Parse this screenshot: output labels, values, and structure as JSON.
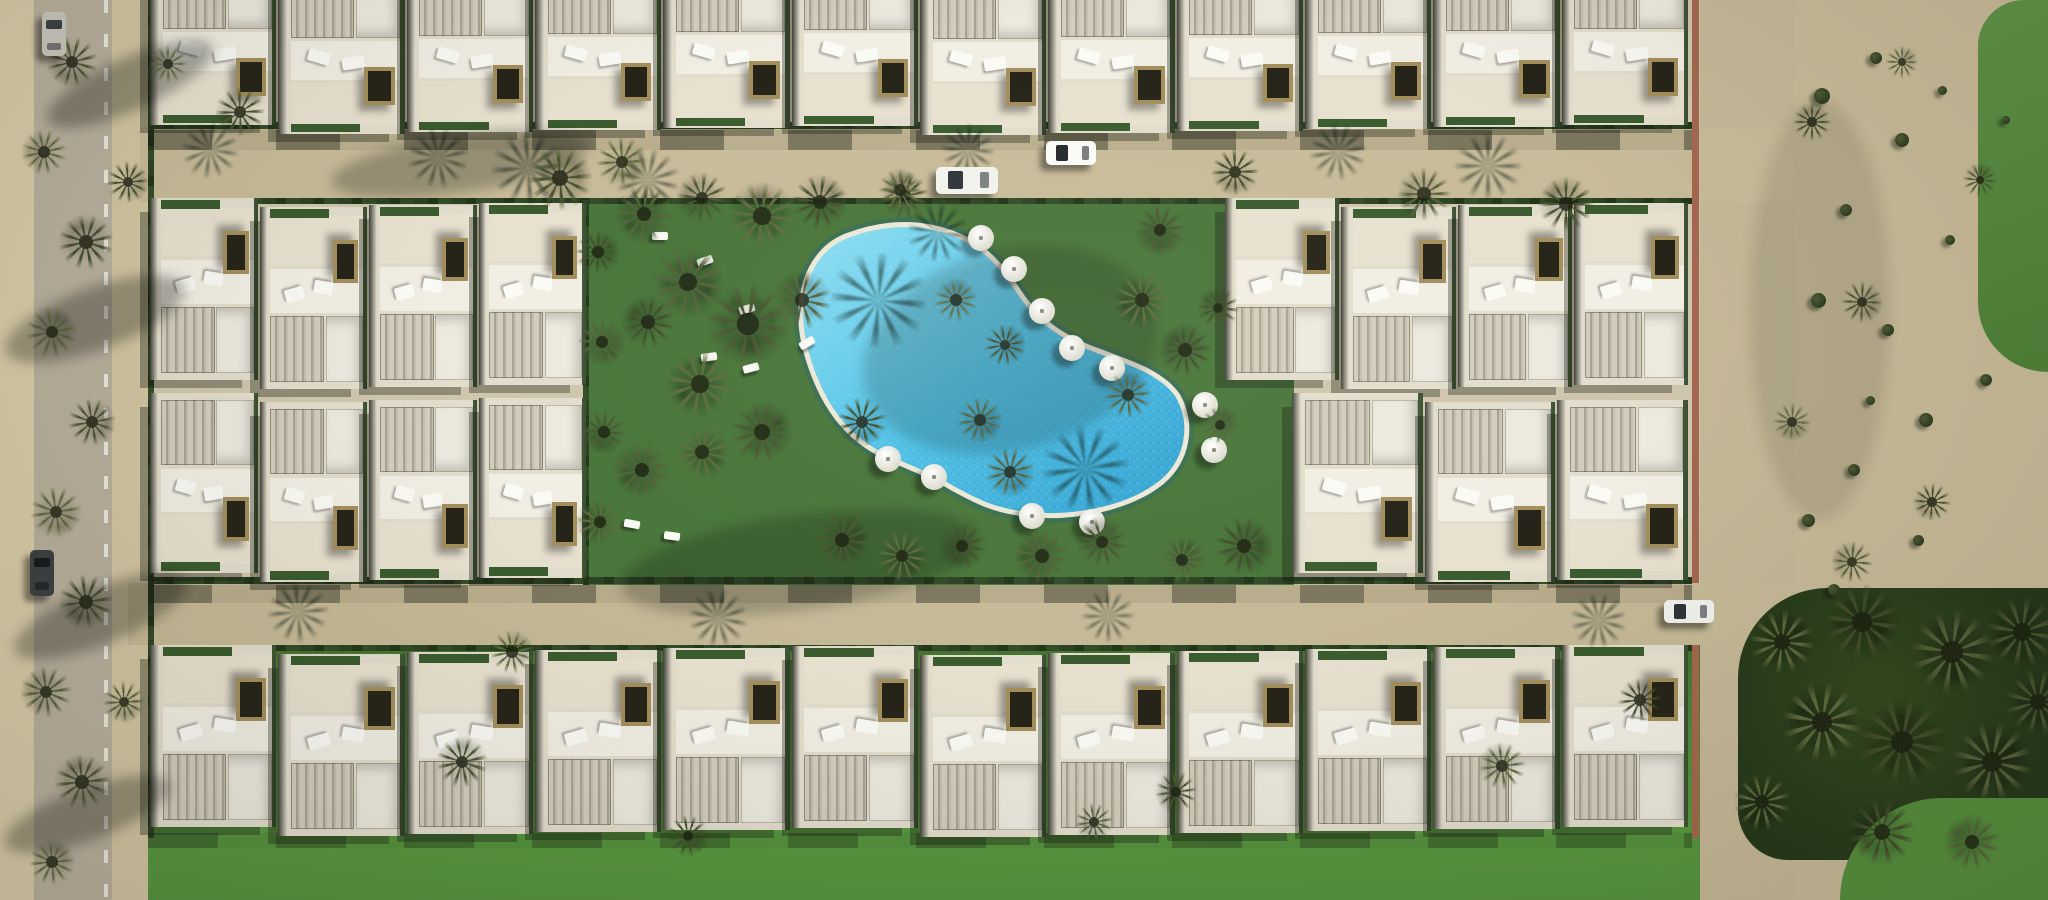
{
  "scene": {
    "width": 2048,
    "height": 900,
    "background": "#c9bc9a",
    "subject": "aerial-3d-render-villa-resort-with-kidney-pool"
  },
  "palette": {
    "road_sand": "#c8bb99",
    "street_grey": "#b9af9d",
    "dune_sand": "#c7ba98",
    "garden_green": "#49763a",
    "lawn_green": "#4f8739",
    "pool_water": "#4cc0e6",
    "villa_white": "#e2ddcd",
    "hedge_green": "#2c4323",
    "wall_terracotta": "#a4674f"
  },
  "regions": [
    {
      "name": "left-sidewalk",
      "x": 0,
      "y": 0,
      "w": 34,
      "h": 900,
      "bg": "#d8cba8",
      "cls": "tex-dune"
    },
    {
      "name": "left-street",
      "x": 34,
      "y": 0,
      "w": 78,
      "h": 900,
      "bg": "#b9af9d",
      "cls": "tex-road"
    },
    {
      "name": "left-street-dash-line",
      "x": 104,
      "y": 0,
      "w": 4,
      "h": 900,
      "bg": "repeating-linear-gradient(180deg, rgba(250,250,243,0.75) 0px 13px, rgba(250,250,243,0) 13px 34px)"
    },
    {
      "name": "left-shoulder",
      "x": 112,
      "y": 0,
      "w": 36,
      "h": 900,
      "bg": "#d2c5a2",
      "cls": "tex-dune"
    },
    {
      "name": "development-ground",
      "x": 148,
      "y": 0,
      "w": 1554,
      "h": 900,
      "bg": "#cfc6ad"
    },
    {
      "name": "right-dune",
      "x": 1795,
      "y": 0,
      "w": 253,
      "h": 900,
      "bg": "#c7ba98",
      "cls": "tex-dune"
    },
    {
      "name": "golf-fairway-top",
      "x": 1978,
      "y": 0,
      "w": 70,
      "h": 372,
      "bg": "linear-gradient(180deg,#5e9247,#4e8038)",
      "cls": "tex-grass",
      "radius": "46px 0 0 70px"
    },
    {
      "name": "perimeter-road-right",
      "x": 1700,
      "y": 0,
      "w": 95,
      "h": 900,
      "bg": "#c5b897",
      "cls": "tex-road"
    },
    {
      "name": "upper-road",
      "x": 140,
      "y": 128,
      "w": 1655,
      "h": 74,
      "bg": "#c8bb99",
      "cls": "tex-road"
    },
    {
      "name": "lower-road",
      "x": 128,
      "y": 583,
      "w": 1667,
      "h": 62,
      "bg": "#c6b997",
      "cls": "tex-road"
    },
    {
      "name": "pool-garden",
      "x": 588,
      "y": 200,
      "w": 706,
      "h": 385,
      "bg": "#49763a",
      "cls": "tex-grass"
    },
    {
      "name": "south-lawn",
      "x": 148,
      "y": 645,
      "w": 1552,
      "h": 255,
      "bg": "linear-gradient(180deg,#45722f 0%,#4f8739 30%,#58983f 70%,#549340 100%)",
      "cls": "tex-lawn"
    },
    {
      "name": "golf-trees-south",
      "x": 1738,
      "y": 588,
      "w": 310,
      "h": 272,
      "bg": "radial-gradient(circle at 45% 40%, #33491f 0%, #24371a 75%)",
      "radius": "90px 0 0 50px"
    },
    {
      "name": "golf-lawn-corner",
      "x": 1840,
      "y": 798,
      "w": 208,
      "h": 102,
      "bg": "#558e3d",
      "cls": "tex-lawn",
      "radius": "110px 0 0 0"
    },
    {
      "name": "boundary-wall-upper",
      "x": 1692,
      "y": 0,
      "w": 7,
      "h": 583,
      "bg": "#a4674f"
    },
    {
      "name": "boundary-wall-lower",
      "x": 1692,
      "y": 645,
      "w": 7,
      "h": 193,
      "bg": "#a4674f"
    },
    {
      "name": "hedge-upper-road-north",
      "x": 148,
      "y": 122,
      "w": 1544,
      "h": 7,
      "bg": "repeating-linear-gradient(90deg,#2c4323 0 16px,#223619 16px 26px,#324c28 26px 40px)"
    },
    {
      "name": "hedge-upper-road-south",
      "x": 148,
      "y": 198,
      "w": 1544,
      "h": 6,
      "bg": "repeating-linear-gradient(90deg,#2c4323 0 14px,#223619 14px 24px,#324c28 24px 38px)"
    },
    {
      "name": "hedge-lower-road-north",
      "x": 148,
      "y": 577,
      "w": 1544,
      "h": 7,
      "bg": "repeating-linear-gradient(90deg,#2c4323 0 16px,#223619 16px 26px,#324c28 26px 40px)"
    },
    {
      "name": "hedge-lower-road-south",
      "x": 148,
      "y": 645,
      "w": 1544,
      "h": 6,
      "bg": "repeating-linear-gradient(90deg,#2c4323 0 14px,#223619 14px 24px,#324c28 24px 38px)"
    },
    {
      "name": "hedge-garden-west",
      "x": 583,
      "y": 200,
      "w": 6,
      "h": 385,
      "bg": "repeating-linear-gradient(180deg,#2c4323 0 16px,#223619 16px 26px,#324c28 26px 40px)"
    },
    {
      "name": "hedge-development-west",
      "x": 148,
      "y": 0,
      "w": 6,
      "h": 838,
      "bg": "repeating-linear-gradient(180deg,#2c4323 0 16px,#223619 16px 26px,#324c28 26px 40px)"
    },
    {
      "name": "building-shadow-upper-road",
      "x": 148,
      "y": 130,
      "w": 1544,
      "h": 20,
      "bg": "repeating-linear-gradient(90deg, rgba(18,22,12,0.42) 0 64px, rgba(18,22,12,0.08) 64px 128px)"
    },
    {
      "name": "building-shadow-lower-road",
      "x": 148,
      "y": 585,
      "w": 1544,
      "h": 18,
      "bg": "repeating-linear-gradient(90deg, rgba(18,22,12,0.4) 0 64px, rgba(18,22,12,0.08) 64px 128px)"
    },
    {
      "name": "building-shadow-lawn",
      "x": 148,
      "y": 833,
      "w": 1544,
      "h": 15,
      "bg": "repeating-linear-gradient(90deg, rgba(18,24,12,0.32) 0 70px, rgba(18,24,12,0.05) 70px 128px)"
    }
  ],
  "pool": {
    "path": "M 846,236 C 806,252 792,302 806,352 C 818,394 838,432 880,454 C 908,468 930,474 952,488 C 974,500 992,510 1024,514 C 1074,520 1130,508 1162,482 C 1188,460 1194,424 1178,396 C 1162,372 1128,362 1096,350 C 1064,338 1040,322 1022,296 C 1004,270 988,246 952,233 C 914,219 876,224 846,236 Z",
    "coping": "#ece8d8",
    "water_light": "#8fdff2",
    "water_mid": "#4cc0e6",
    "water_deep": "#2f9fd0",
    "edge_shade": "rgba(23,94,134,0.3)"
  },
  "villa_style": {
    "base": "#e2ddcd",
    "roof_light": "#eceadf",
    "terrace": "#f1eee3",
    "patio": "#e8e1cf",
    "stripe_a": "#d2cdbd",
    "stripe_b": "#a8a493",
    "stripe_c": "#c4bfae",
    "pergola_frame": "#a38f5c",
    "pergola_dark": "#262419",
    "hedge": "#2e4626",
    "alley": "rgba(22,24,18,0.8)"
  },
  "villa_rows": [
    {
      "name": "villas-north-row",
      "x0": 150,
      "x1": 1690,
      "y": -30,
      "h": 160,
      "count": 12,
      "facing": "down"
    },
    {
      "name": "villas-mid-west-upper",
      "x0": 150,
      "x1": 588,
      "y": 203,
      "h": 182,
      "count": 4,
      "facing": "up"
    },
    {
      "name": "villas-mid-east-upper",
      "x0": 1225,
      "x1": 1690,
      "y": 203,
      "h": 182,
      "count": 4,
      "facing": "up"
    },
    {
      "name": "villas-mid-west-lower",
      "x0": 150,
      "x1": 588,
      "y": 398,
      "h": 180,
      "count": 4,
      "facing": "down"
    },
    {
      "name": "villas-mid-east-lower",
      "x0": 1292,
      "x1": 1690,
      "y": 398,
      "h": 180,
      "count": 3,
      "facing": "down"
    },
    {
      "name": "villas-south-row",
      "x0": 150,
      "x1": 1690,
      "y": 650,
      "h": 182,
      "count": 12,
      "facing": "up"
    }
  ],
  "tree_tones": [
    "#55603a",
    "#4a5531",
    "#5f6a3e",
    "#424d2b"
  ],
  "trees": [
    [
      644,
      214,
      62
    ],
    [
      702,
      198,
      54
    ],
    [
      762,
      216,
      72
    ],
    [
      820,
      202,
      58
    ],
    [
      688,
      282,
      78
    ],
    [
      748,
      324,
      88
    ],
    [
      700,
      384,
      72
    ],
    [
      648,
      322,
      56
    ],
    [
      802,
      300,
      62
    ],
    [
      762,
      432,
      66
    ],
    [
      702,
      452,
      56
    ],
    [
      862,
      422,
      52
    ],
    [
      642,
      470,
      60
    ],
    [
      905,
      196,
      50
    ],
    [
      956,
      300,
      46
    ],
    [
      1005,
      345,
      44
    ],
    [
      980,
      420,
      48
    ],
    [
      1160,
      230,
      54
    ],
    [
      1142,
      300,
      60
    ],
    [
      1185,
      350,
      56
    ],
    [
      1128,
      395,
      50
    ],
    [
      560,
      178,
      68
    ],
    [
      622,
      162,
      54
    ],
    [
      1235,
      172,
      50
    ],
    [
      1424,
      194,
      56
    ],
    [
      1566,
      204,
      58
    ],
    [
      900,
      190,
      46
    ],
    [
      598,
      252,
      46
    ],
    [
      602,
      342,
      50
    ],
    [
      604,
      432,
      46
    ],
    [
      600,
      522,
      50
    ],
    [
      1218,
      308,
      44
    ],
    [
      1220,
      425,
      40
    ],
    [
      842,
      540,
      58
    ],
    [
      902,
      556,
      54
    ],
    [
      962,
      546,
      50
    ],
    [
      1042,
      556,
      58
    ],
    [
      1102,
      542,
      54
    ],
    [
      1182,
      560,
      50
    ],
    [
      1244,
      546,
      62
    ],
    [
      1010,
      472,
      52
    ],
    [
      72,
      62,
      54
    ],
    [
      44,
      152,
      48
    ],
    [
      86,
      242,
      58
    ],
    [
      52,
      332,
      54
    ],
    [
      92,
      422,
      50
    ],
    [
      56,
      512,
      54
    ],
    [
      86,
      602,
      58
    ],
    [
      46,
      692,
      54
    ],
    [
      82,
      782,
      58
    ],
    [
      52,
      862,
      48
    ],
    [
      128,
      182,
      44
    ],
    [
      124,
      702,
      44
    ],
    [
      240,
      112,
      52
    ],
    [
      168,
      64,
      40
    ],
    [
      1812,
      122,
      40
    ],
    [
      1902,
      62,
      34
    ],
    [
      1862,
      302,
      44
    ],
    [
      1792,
      422,
      40
    ],
    [
      1932,
      502,
      40
    ],
    [
      1852,
      562,
      44
    ],
    [
      1980,
      180,
      36
    ],
    [
      1782,
      642,
      68
    ],
    [
      1862,
      622,
      80
    ],
    [
      1952,
      652,
      88
    ],
    [
      2022,
      632,
      74
    ],
    [
      1822,
      722,
      84
    ],
    [
      1902,
      742,
      94
    ],
    [
      1992,
      762,
      84
    ],
    [
      2038,
      702,
      70
    ],
    [
      1762,
      802,
      60
    ],
    [
      1882,
      832,
      70
    ],
    [
      1972,
      842,
      60
    ],
    [
      462,
      762,
      54
    ],
    [
      512,
      652,
      46
    ],
    [
      688,
      836,
      44
    ],
    [
      1094,
      822,
      40
    ],
    [
      1176,
      792,
      44
    ],
    [
      1502,
      766,
      50
    ],
    [
      1640,
      700,
      46
    ]
  ],
  "shadow_palms": [
    [
      878,
      300,
      95
    ],
    [
      1085,
      468,
      85
    ],
    [
      938,
      232,
      60
    ],
    [
      528,
      168,
      72
    ],
    [
      648,
      180,
      62
    ],
    [
      1488,
      166,
      66
    ],
    [
      438,
      158,
      60
    ],
    [
      968,
      150,
      52
    ],
    [
      1338,
      152,
      56
    ],
    [
      210,
      150,
      56
    ],
    [
      298,
      612,
      60
    ],
    [
      718,
      618,
      58
    ],
    [
      1108,
      616,
      52
    ],
    [
      1598,
      620,
      55
    ]
  ],
  "umbrellas": [
    [
      981,
      238
    ],
    [
      1014,
      269
    ],
    [
      1042,
      311
    ],
    [
      1072,
      348
    ],
    [
      1112,
      368
    ],
    [
      1205,
      405
    ],
    [
      1214,
      450
    ],
    [
      888,
      459
    ],
    [
      934,
      477
    ],
    [
      1032,
      516
    ],
    [
      1092,
      522
    ]
  ],
  "loungers": [
    [
      697,
      257,
      -20
    ],
    [
      739,
      305,
      -15
    ],
    [
      799,
      339,
      -30
    ],
    [
      743,
      364,
      -15
    ],
    [
      701,
      353,
      -8
    ],
    [
      652,
      232,
      0
    ],
    [
      624,
      520,
      10
    ],
    [
      664,
      532,
      8
    ]
  ],
  "shrubs": [
    [
      1822,
      96,
      16
    ],
    [
      1876,
      58,
      12
    ],
    [
      1902,
      140,
      14
    ],
    [
      1846,
      210,
      12
    ],
    [
      1818,
      300,
      15
    ],
    [
      1888,
      330,
      12
    ],
    [
      1926,
      420,
      14
    ],
    [
      1854,
      470,
      12
    ],
    [
      1808,
      520,
      13
    ],
    [
      1918,
      540,
      11
    ],
    [
      1986,
      380,
      12
    ],
    [
      1950,
      240,
      10
    ],
    [
      2006,
      120,
      8
    ],
    [
      1834,
      590,
      12
    ],
    [
      1942,
      90,
      9
    ],
    [
      1870,
      400,
      9
    ]
  ],
  "cars": [
    {
      "name": "car-white-sedan-upper-road",
      "x": 936,
      "y": 167,
      "w": 62,
      "h": 27,
      "body": "#f3f3ee",
      "glass": "#2e3438",
      "vert": false
    },
    {
      "name": "car-white-suv-upper-road",
      "x": 1046,
      "y": 141,
      "w": 50,
      "h": 24,
      "body": "#fafaf6",
      "glass": "#23282c",
      "vert": false
    },
    {
      "name": "car-white-sedan-lower-road",
      "x": 1664,
      "y": 600,
      "w": 50,
      "h": 23,
      "body": "#f1f2ee",
      "glass": "#2e3438",
      "vert": false
    },
    {
      "name": "car-dark-left-street",
      "x": 30,
      "y": 550,
      "w": 24,
      "h": 46,
      "body": "#3c4042",
      "glass": "#16191b",
      "vert": true
    },
    {
      "name": "car-grey-left-street-top",
      "x": 42,
      "y": 12,
      "w": 24,
      "h": 44,
      "body": "#c9c6bd",
      "glass": "#3c4042",
      "vert": true
    }
  ],
  "shadow_streaks": [
    [
      330,
      136,
      260,
      56,
      -8,
      0.26
    ],
    [
      40,
      58,
      180,
      52,
      -24,
      0.32
    ],
    [
      0,
      288,
      190,
      62,
      -20,
      0.3
    ],
    [
      8,
      588,
      185,
      56,
      -22,
      0.3
    ],
    [
      0,
      788,
      175,
      52,
      -20,
      0.3
    ],
    [
      620,
      515,
      360,
      95,
      -8,
      0.22
    ],
    [
      860,
      250,
      300,
      200,
      -15,
      0.18
    ],
    [
      1750,
      100,
      140,
      420,
      0,
      0.1
    ]
  ]
}
